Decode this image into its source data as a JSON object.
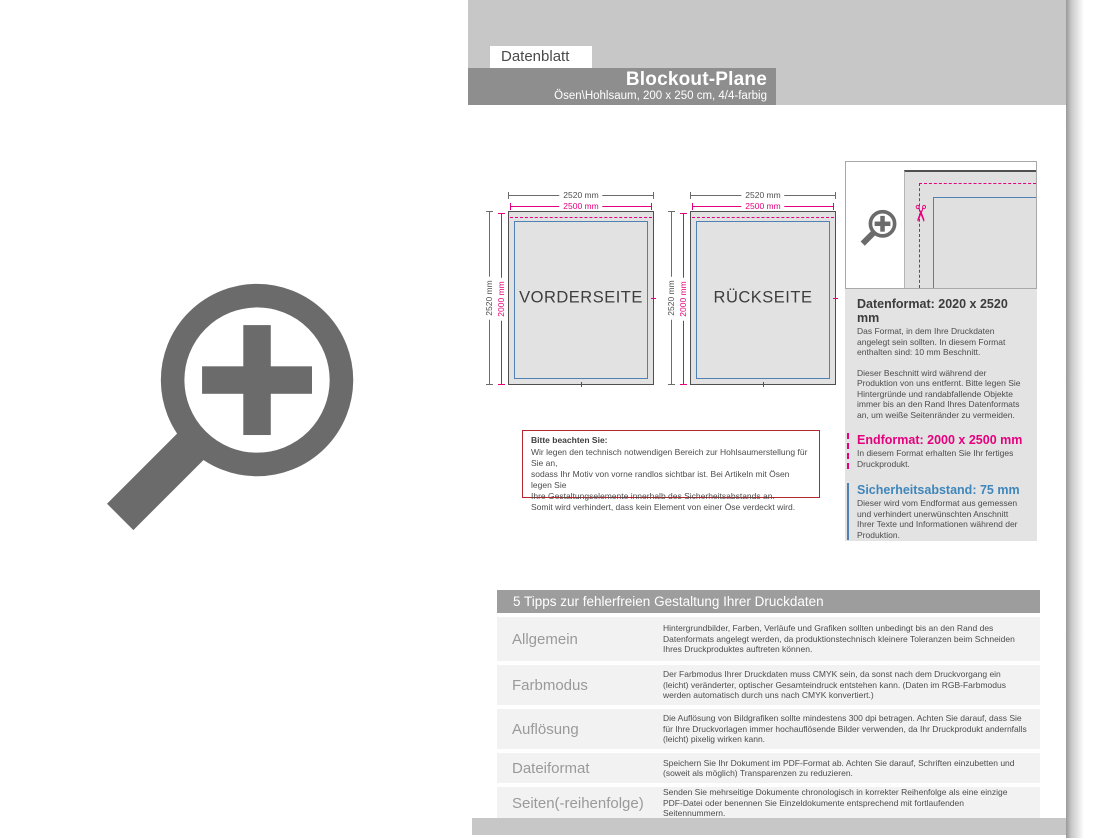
{
  "header": {
    "tab_label": "Datenblatt",
    "title": "Blockout-Plane",
    "subtitle": "Ösen\\Hohlsaum, 200 x 250 cm, 4/4-farbig"
  },
  "diagrams": {
    "dimensions": {
      "top_outer": "2520 mm",
      "top_inner": "2500 mm",
      "left_outer": "2520 mm",
      "left_inner": "2000 mm"
    },
    "front_label": "VORDERSEITE",
    "back_label": "RÜCKSEITE"
  },
  "note_box": {
    "title": "Bitte beachten Sie:",
    "lines": [
      "Wir legen den technisch notwendigen Bereich zur Hohlsaumerstellung für Sie an,",
      "sodass Ihr Motiv von vorne randlos sichtbar ist. Bei Artikeln mit Ösen legen Sie",
      "Ihre Gestaltungselemente innerhalb des Sicherheitsabstands an.",
      "Somit wird verhindert, dass kein Element von einer Öse verdeckt wird."
    ]
  },
  "info_panel": {
    "datenformat": {
      "heading": "Datenformat: 2020 x 2520 mm",
      "para1": "Das Format, in dem Ihre Druckdaten angelegt sein sollten. In diesem Format enthalten sind: 10 mm Beschnitt.",
      "para2": "Dieser Beschnitt wird während der Produktion von uns entfernt. Bitte legen Sie Hintergründe und randabfallende Objekte immer bis an den Rand Ihres Datenformats an, um weiße Seitenränder zu vermeiden."
    },
    "endformat": {
      "heading": "Endformat: 2000 x 2500 mm",
      "text": "In diesem Format erhalten Sie Ihr fertiges Druckprodukt."
    },
    "sicherheitsabstand": {
      "heading": "Sicherheitsabstand: 75 mm",
      "text": "Dieser wird vom Endformat aus gemessen und verhindert unerwünschten Anschnitt Ihrer Texte und Informationen während der Produktion."
    }
  },
  "tips_table": {
    "header": "5 Tipps zur fehlerfreien Gestaltung Ihrer Druckdaten",
    "rows": [
      {
        "label": "Allgemein",
        "text": "Hintergrundbilder, Farben, Verläufe und Grafiken sollten unbedingt bis an den Rand des Datenformats angelegt werden, da produktionstechnisch kleinere Toleranzen beim Schneiden Ihres Druckproduktes auftreten können."
      },
      {
        "label": "Farbmodus",
        "text": "Der Farbmodus Ihrer Druckdaten muss CMYK sein, da sonst nach dem Druckvorgang ein (leicht) veränderter, optischer Gesamteindruck entstehen kann. (Daten im RGB-Farbmodus werden automatisch durch uns nach CMYK konvertiert.)"
      },
      {
        "label": "Auflösung",
        "text": "Die Auflösung von Bildgrafiken sollte mindestens 300 dpi betragen. Achten Sie darauf, dass Sie für Ihre Druckvorlagen immer hochauflösende Bilder verwenden, da Ihr Druckprodukt andernfalls (leicht) pixelig wirken kann."
      },
      {
        "label": "Dateiformat",
        "text": "Speichern Sie Ihr Dokument im PDF-Format ab. Achten Sie darauf, Schriften einzubetten und (soweit als möglich) Transparenzen zu reduzieren."
      },
      {
        "label": "Seiten(-reihenfolge)",
        "text": "Senden Sie mehrseitige Dokumente chronologisch in korrekter Reihenfolge als eine einzige PDF-Datei oder benennen Sie Einzeldokumente entsprechend mit fortlaufenden Seitennummern."
      }
    ]
  },
  "icons": {
    "scissors_glyph": "✂",
    "magnifier_name": "zoom-plus-magnifier"
  },
  "colors": {
    "magenta": "#e5007d",
    "blue": "#4f81b4",
    "blue_heading": "#3f86ba",
    "note_border": "#b3282d",
    "band_gray": "#c7c7c7",
    "titlebar_gray": "#8e8e8e",
    "table_header_gray": "#9d9d9d"
  }
}
